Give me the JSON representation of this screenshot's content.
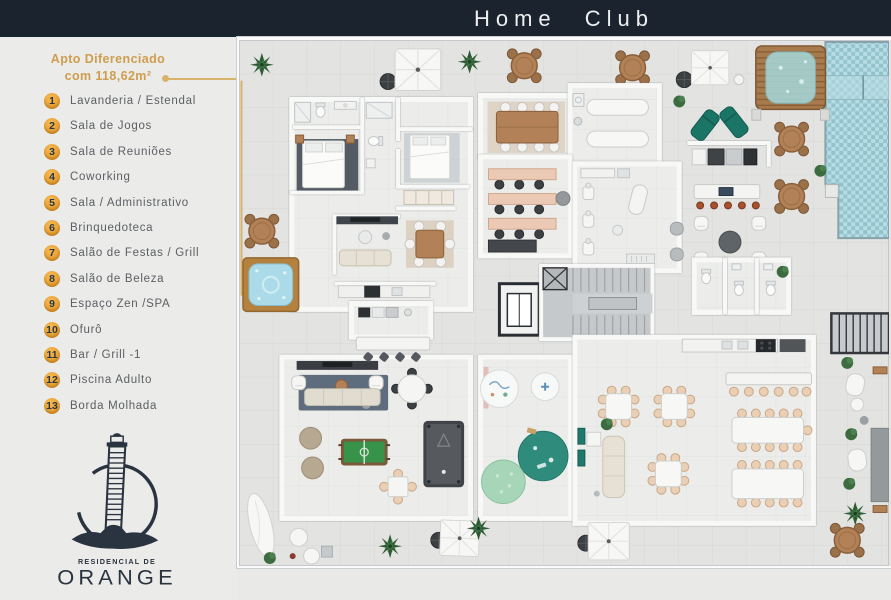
{
  "header": {
    "title": "Home Club"
  },
  "sidebar": {
    "callout": {
      "line1": "Apto Diferenciado",
      "line2": "com 118,62m²"
    },
    "legend": [
      {
        "num": "1",
        "label": "Lavanderia / Estendal"
      },
      {
        "num": "2",
        "label": "Sala de Jogos"
      },
      {
        "num": "3",
        "label": "Sala de Reuniões"
      },
      {
        "num": "4",
        "label": "Coworking"
      },
      {
        "num": "5",
        "label": "Sala / Administrativo"
      },
      {
        "num": "6",
        "label": "Brinquedoteca"
      },
      {
        "num": "7",
        "label": "Salão de Festas / Grill"
      },
      {
        "num": "8",
        "label": "Salão de Beleza"
      },
      {
        "num": "9",
        "label": "Espaço Zen /SPA"
      },
      {
        "num": "10",
        "label": "Ofurô"
      },
      {
        "num": "11",
        "label": "Bar / Grill -1"
      },
      {
        "num": "12",
        "label": "Piscina Adulto"
      },
      {
        "num": "13",
        "label": "Borda Molhada"
      }
    ],
    "logo": {
      "subtitle": "RESIDENCIAL DE",
      "name": "ORANGE"
    }
  },
  "colors": {
    "topbar_navy": "#1b242e",
    "accent_gold": "#e3a33c",
    "leader_gold": "#d9b36a",
    "sidebar_bg": "#ebebe9",
    "legend_text": "#5b5e63",
    "pool_blue": "#a3ced8",
    "teal_furniture": "#1b7567"
  }
}
